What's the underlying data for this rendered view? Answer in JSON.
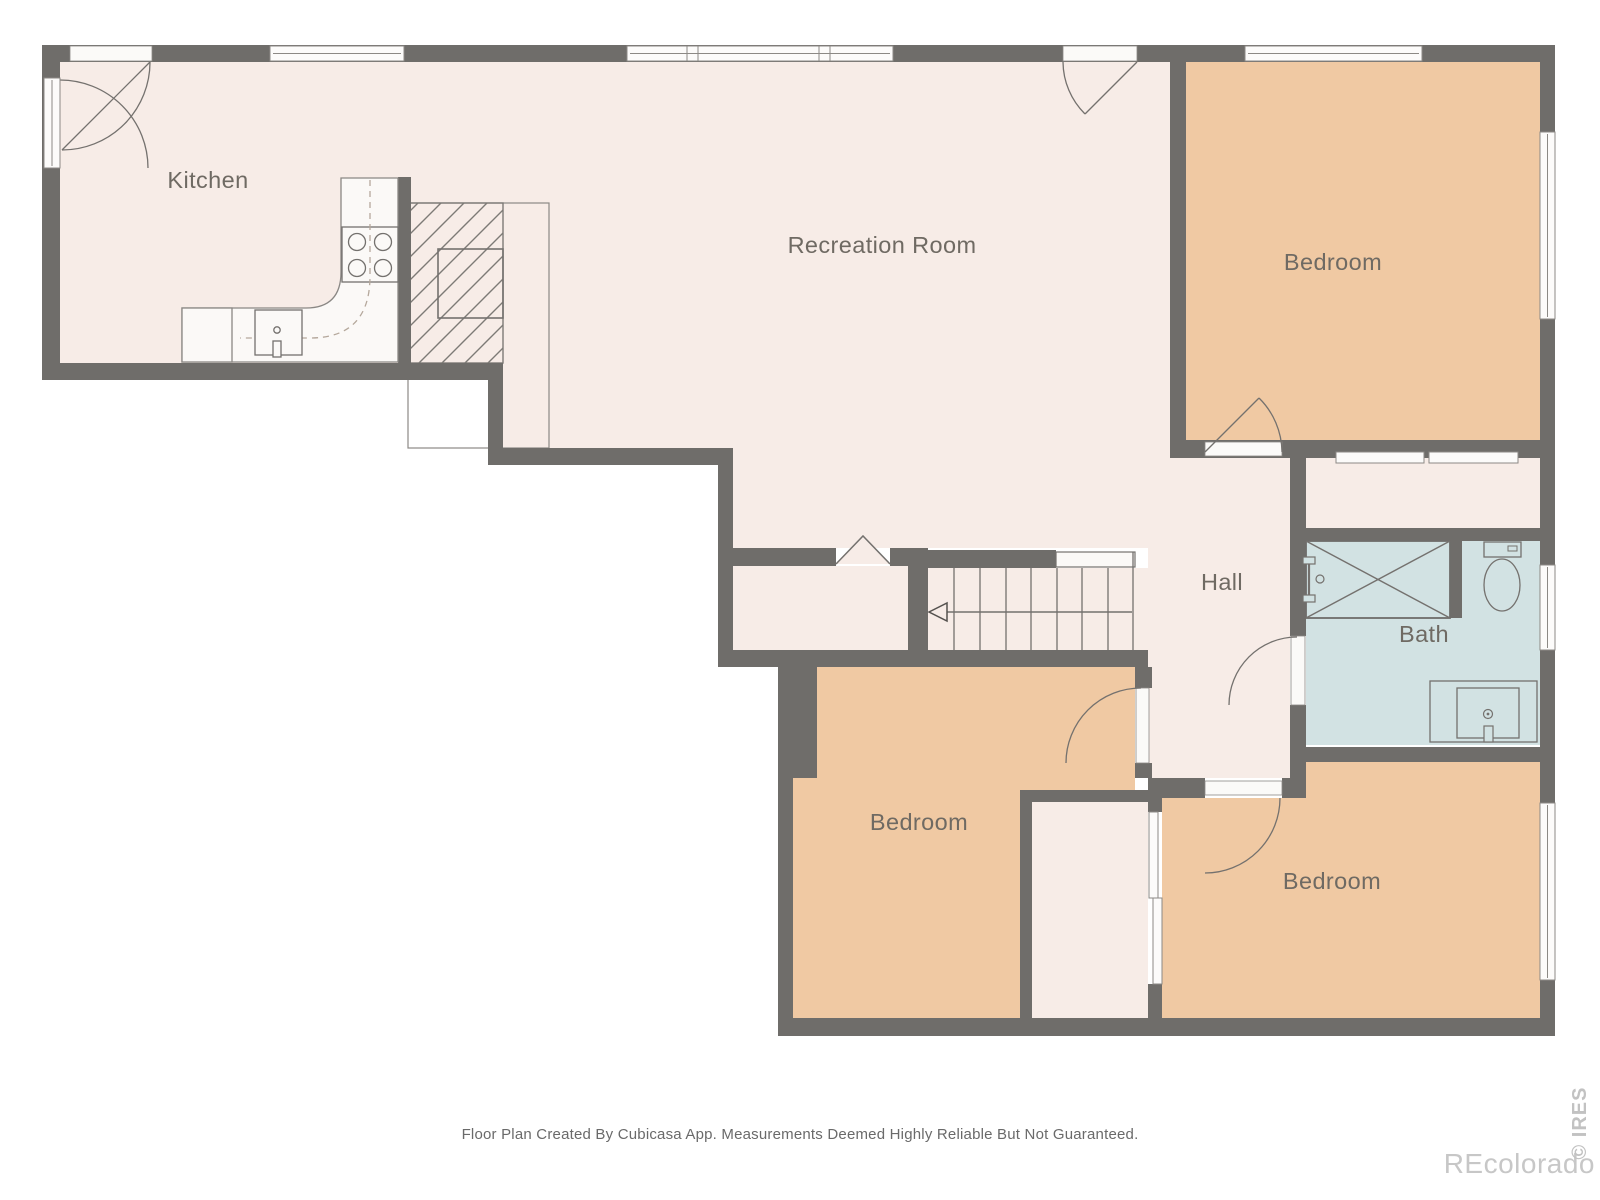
{
  "floor_plan": {
    "rooms": {
      "kitchen": {
        "label": "Kitchen"
      },
      "recreation": {
        "label": "Recreation Room"
      },
      "bedroom_top_right": {
        "label": "Bedroom"
      },
      "hall": {
        "label": "Hall"
      },
      "bath": {
        "label": "Bath"
      },
      "bedroom_bottom_middle": {
        "label": "Bedroom"
      },
      "bedroom_bottom_right": {
        "label": "Bedroom"
      }
    }
  },
  "footer": {
    "disclaimer": "Floor Plan Created By Cubicasa App. Measurements Deemed Highly Reliable But Not Guaranteed."
  },
  "watermarks": {
    "brand": "REcolorado",
    "mls": "© IRES"
  },
  "colors": {
    "wall": "#6f6d6a",
    "floor_cream": "#f7ece7",
    "floor_tan": "#f0c9a3",
    "floor_bath_blue": "#d2e2e3",
    "fixture_white": "#fbf9f7",
    "symbol_line_gray": "#7d7a76",
    "label_text": "#6f6a63",
    "footer_text": "#6a6a6a",
    "watermark_gray": "#c7c7c7"
  }
}
